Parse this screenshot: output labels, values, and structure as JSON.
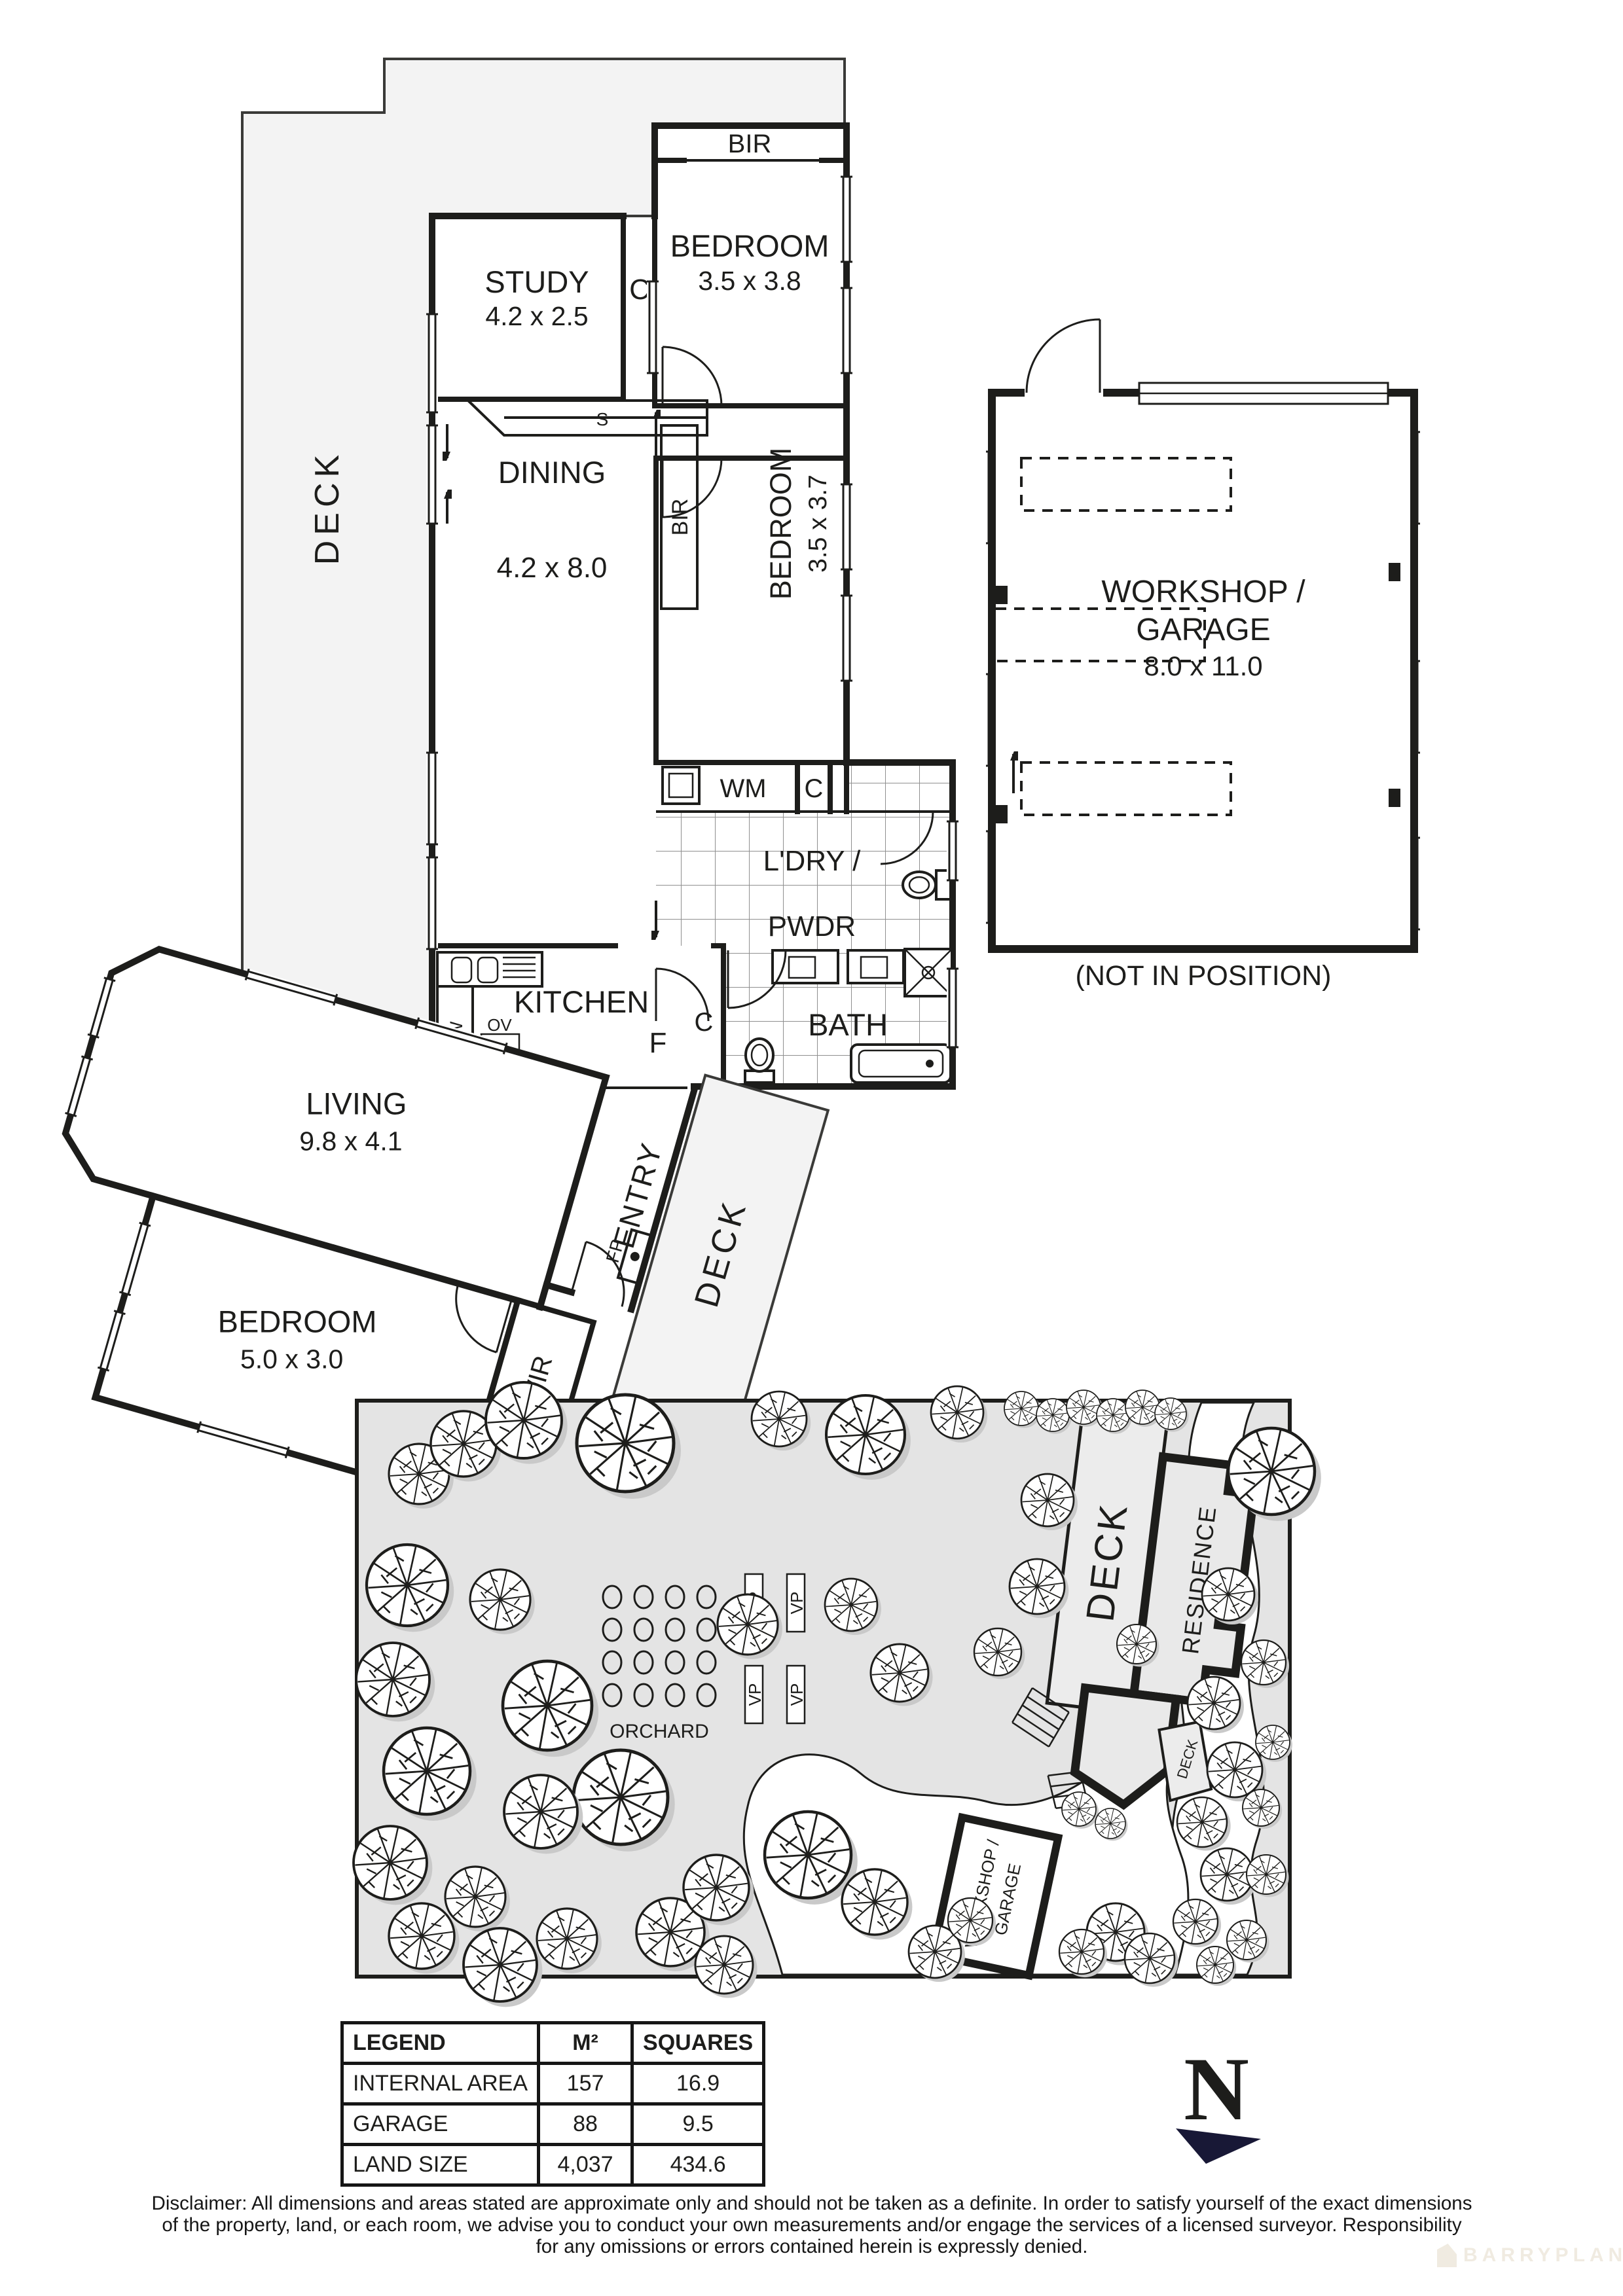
{
  "floorplan": {
    "deck_label": "DECK",
    "bir_top": "BIR",
    "bedroom1": {
      "name": "BEDROOM",
      "dims": "3.5 x 3.8"
    },
    "study": {
      "name": "STUDY",
      "dims": "4.2 x 2.5"
    },
    "c_hall": "C",
    "shelf": "S",
    "dining": {
      "name": "DINING",
      "dims": "4.2 x 8.0"
    },
    "bedroom2": {
      "name": "BEDROOM",
      "dims": "3.5 x 3.7"
    },
    "bir_robe": "BIR",
    "wm": "WM",
    "c_laundry": "C",
    "laundry_line1": "L'DRY /",
    "laundry_line2": "PWDR",
    "c_kitchen": "C",
    "kitchen": "KITCHEN",
    "dw": "DW",
    "ov": "OV",
    "fridge": "F",
    "bath": "BATH",
    "living": {
      "name": "LIVING",
      "dims": "9.8 x 4.1"
    },
    "entry": "ENTRY",
    "fp": "FP",
    "deck_lower": "DECK",
    "bedroom3": {
      "name": "BEDROOM",
      "dims": "5.0 x 3.0"
    },
    "wir": "WIR"
  },
  "workshop": {
    "name_line1": "WORKSHOP /",
    "name_line2": "GARAGE",
    "dims": "8.0 x 11.0",
    "caption": "(NOT IN POSITION)"
  },
  "siteplan": {
    "deck": "DECK",
    "residence": "RESIDENCE",
    "deck_small": "DECK",
    "workshop_line1": "WORKSHOP /",
    "workshop_line2": "GARAGE",
    "orchard": "ORCHARD",
    "vp": "VP"
  },
  "legend": {
    "title": "LEGEND",
    "col_m2": "M²",
    "col_squares": "SQUARES",
    "rows": [
      {
        "label": "INTERNAL AREA",
        "m2": "157",
        "squares": "16.9"
      },
      {
        "label": "GARAGE",
        "m2": "88",
        "squares": "9.5"
      },
      {
        "label": "LAND SIZE",
        "m2": "4,037",
        "squares": "434.6"
      }
    ]
  },
  "compass": {
    "north": "N"
  },
  "disclaimer": {
    "line1": "Disclaimer: All dimensions and areas stated are approximate only and should not be taken as a definite. In order to satisfy yourself of the exact dimensions",
    "line2": "of the property, land, or each room, we advise you to conduct your own measurements and/or engage the services of a licensed surveyor. Responsibility",
    "line3": "for any omissions or errors contained herein is expressly denied."
  },
  "watermark": "BARRYPLANT"
}
